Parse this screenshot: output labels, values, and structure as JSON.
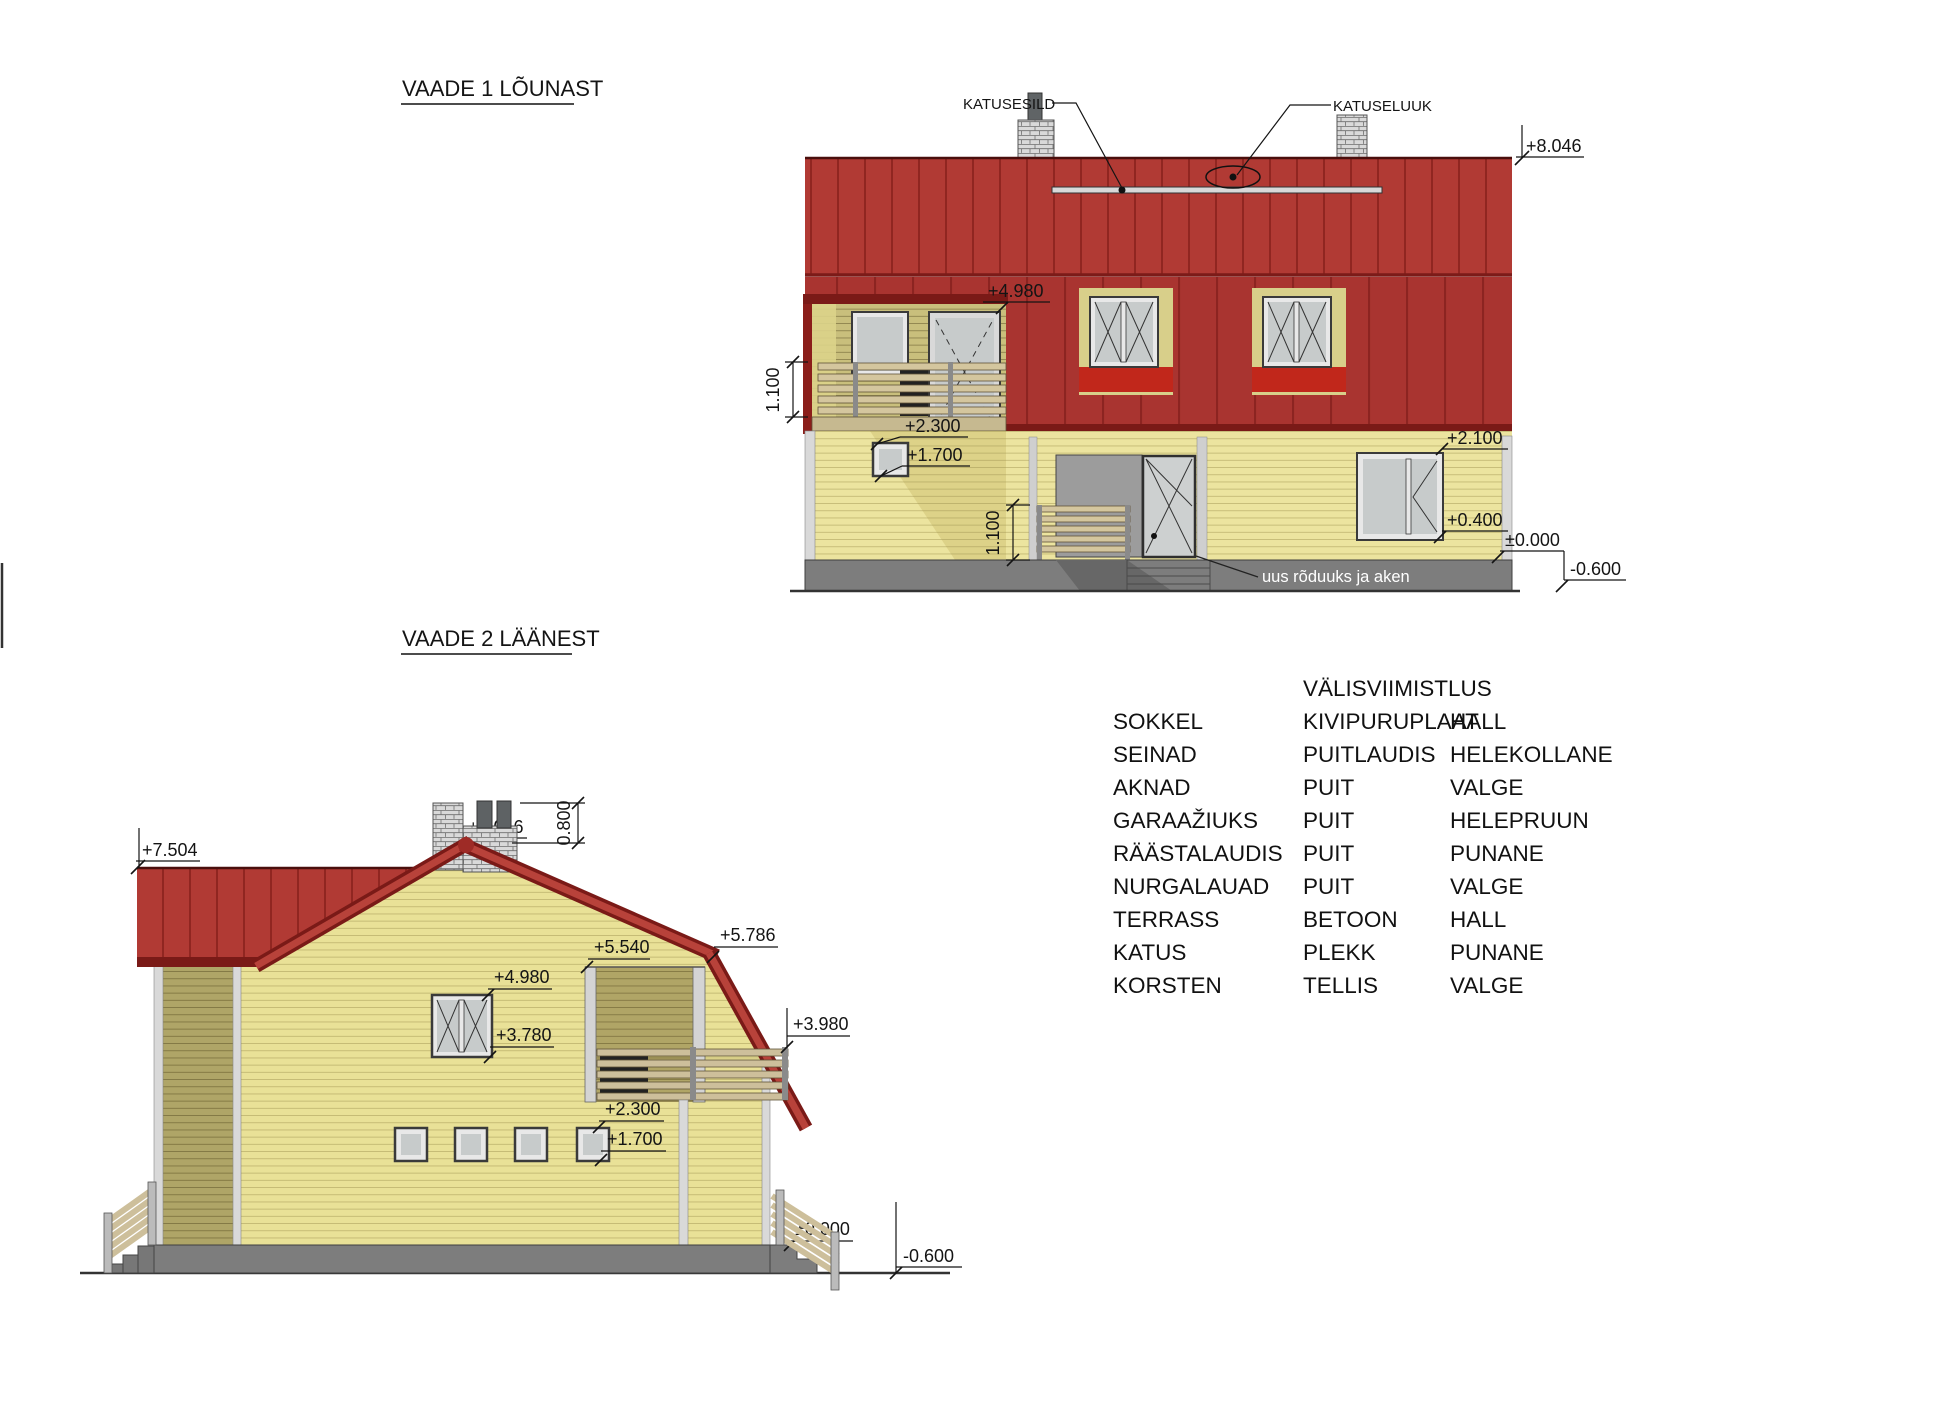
{
  "sheet": {
    "width_px": 1942,
    "height_px": 1411,
    "background": "#ffffff"
  },
  "palette": {
    "roof_red": "#b13a34",
    "roof_band_red": "#a93430",
    "roof_trim_dark": "#7a1a17",
    "window_sill_red": "#c1271b",
    "wall_yellow": "#ece49f",
    "gable_yellow": "#e9e197",
    "recess_olive": "#c9bf7c",
    "shaded_olive": "#a89e62",
    "plinth_gray": "#7d7d7d",
    "frame_gray": "#e8e8e8",
    "glass_gray": "#c7cbcb",
    "railing_wood": "#d2c49e",
    "brick_gray": "#d9d9d9"
  },
  "view1": {
    "title": "VAADE 1 LÕUNAST",
    "callouts": {
      "katusesild": "KATUSESILD",
      "katuseluuk": "KATUSELUUK"
    },
    "note": "uus rõduuks ja aken",
    "dims": {
      "roof_ridge": "+8.046",
      "loft_ceiling": "+4.980",
      "balcony_railing_height": "1.100",
      "small_window_top": "+2.300",
      "small_window_bottom": "+1.700",
      "porch_railing_height": "1.100",
      "window_top": "+2.100",
      "window_bottom": "+0.400",
      "floor_level": "±0.000",
      "ground_level": "-0.600"
    }
  },
  "view2": {
    "title": "VAADE 2 LÄÄNEST",
    "dims": {
      "main_ridge": "+7.504",
      "chimney_top": "+8.046",
      "chimney_height": "0.800",
      "roof_knee": "+5.786",
      "loggia_top": "+5.540",
      "window_top": "+4.980",
      "railing_top": "+3.980",
      "window_bottom": "+3.780",
      "small_window_top": "+2.300",
      "small_window_bottom": "+1.700",
      "floor_level": "±0.000",
      "ground_level": "-0.600"
    }
  },
  "materials_table": {
    "title": "VÄLISVIIMISTLUS",
    "rows": [
      {
        "part": "SOKKEL",
        "material": "KIVIPURUPLAAT",
        "color": "HALL"
      },
      {
        "part": "SEINAD",
        "material": "PUITLAUDIS",
        "color": "HELEKOLLANE"
      },
      {
        "part": "AKNAD",
        "material": "PUIT",
        "color": "VALGE"
      },
      {
        "part": "GARAAŽIUKS",
        "material": "PUIT",
        "color": "HELEPRUUN"
      },
      {
        "part": "RÄÄSTALAUDIS",
        "material": "PUIT",
        "color": "PUNANE"
      },
      {
        "part": "NURGALAUAD",
        "material": "PUIT",
        "color": "VALGE"
      },
      {
        "part": "TERRASS",
        "material": "BETOON",
        "color": "HALL"
      },
      {
        "part": "KATUS",
        "material": "PLEKK",
        "color": "PUNANE"
      },
      {
        "part": "KORSTEN",
        "material": "TELLIS",
        "color": "VALGE"
      }
    ]
  }
}
